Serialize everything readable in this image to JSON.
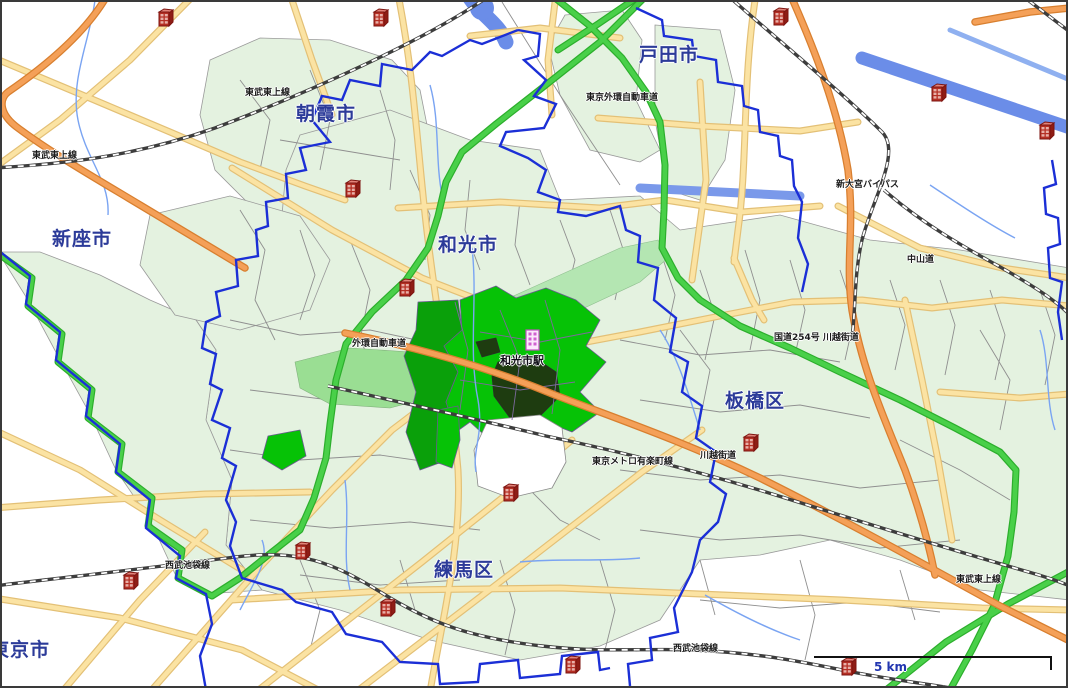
{
  "labels": {
    "cities": [
      {
        "id": "toda",
        "text": "戸田市"
      },
      {
        "id": "asaka",
        "text": "朝霞市"
      },
      {
        "id": "wako",
        "text": "和光市"
      },
      {
        "id": "niiza",
        "text": "新座市"
      },
      {
        "id": "itabashi",
        "text": "板橋区"
      },
      {
        "id": "nerima",
        "text": "練馬区"
      },
      {
        "id": "tokyo",
        "text": "東京市"
      }
    ],
    "station": {
      "text": "和光市駅"
    },
    "roads": [
      {
        "text": "東武東上線"
      },
      {
        "text": "東武東上線"
      },
      {
        "text": "東京外環自動車道"
      },
      {
        "text": "国道254号 川越街道"
      },
      {
        "text": "外環自動車道"
      },
      {
        "text": "東京メトロ有楽町線"
      },
      {
        "text": "川越街道"
      },
      {
        "text": "西武池袋線"
      },
      {
        "text": "西武池袋線"
      },
      {
        "text": "中山道"
      },
      {
        "text": "新大宮バイパス"
      },
      {
        "text": "東武東上線"
      }
    ],
    "scale": {
      "text": "5 km",
      "distance_km": 5
    }
  },
  "icons": {
    "building_marker": "building-icon",
    "city_hall_marker": "city-hall-icon"
  },
  "markers": {
    "buildings": [
      [
        155,
        5
      ],
      [
        370,
        5
      ],
      [
        770,
        4
      ],
      [
        928,
        80
      ],
      [
        1036,
        118
      ],
      [
        342,
        176
      ],
      [
        396,
        275
      ],
      [
        740,
        430
      ],
      [
        500,
        480
      ],
      [
        292,
        538
      ],
      [
        120,
        568
      ],
      [
        377,
        595
      ],
      [
        562,
        652
      ],
      [
        838,
        654
      ]
    ],
    "city_hall": [
      522,
      326
    ]
  },
  "choropleth": {
    "levels": [
      {
        "name": "highest",
        "color": "#1e3c10"
      },
      {
        "name": "high",
        "color": "#06c206"
      },
      {
        "name": "medium",
        "color": "#0aa00a"
      },
      {
        "name": "low",
        "color": "#9ade93"
      },
      {
        "name": "band",
        "color": "#b4e6b2"
      },
      {
        "name": "base-residential",
        "color": "#e4f2e0"
      },
      {
        "name": "no-data",
        "color": "#ffffff"
      }
    ]
  },
  "palette": {
    "boundary_blue": "#1b2fd6",
    "expressway_green": "#49d049",
    "highway_orange": "#f4a058",
    "road_yellow": "#fbe3a3",
    "river_blue": "#6b8de8",
    "railway_gray": "#3d3d3d",
    "city_label": "#2c3b99",
    "marker_red": "#b52f24",
    "marker_pink": "#d060d0"
  }
}
